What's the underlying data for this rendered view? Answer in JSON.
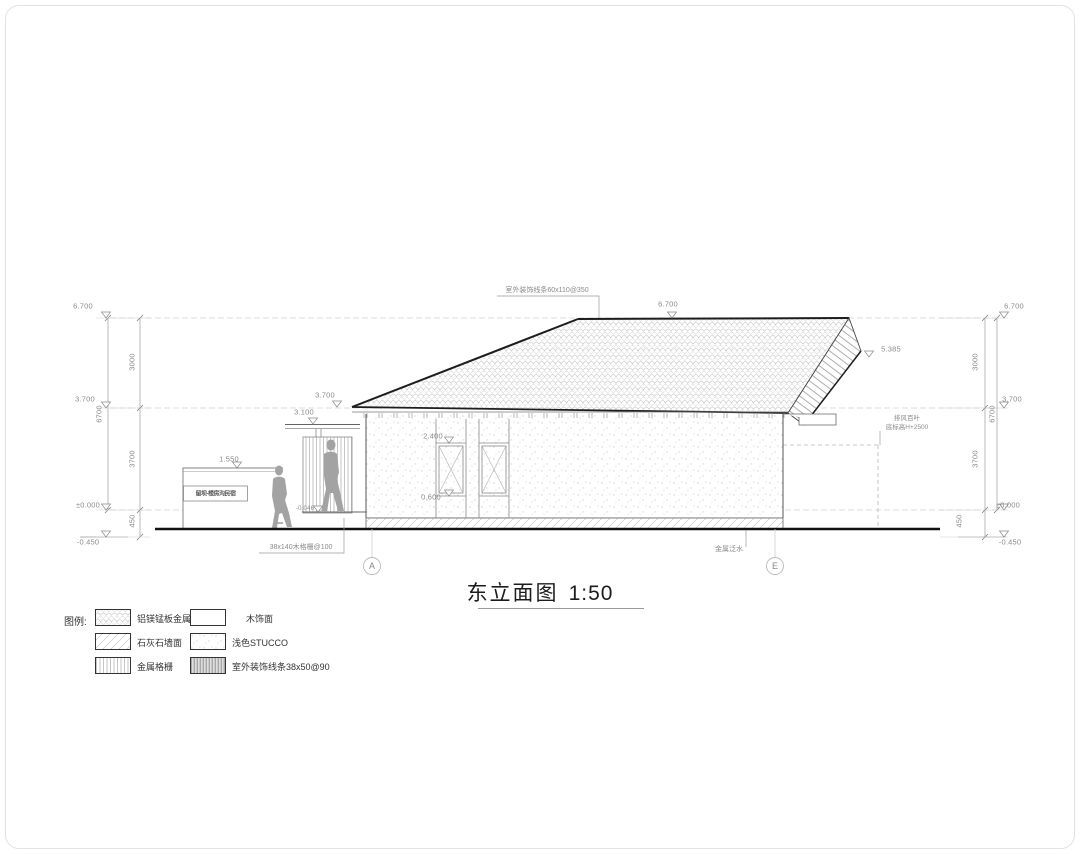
{
  "title": {
    "text": "东立面图",
    "scale": "1:50"
  },
  "levels": {
    "top": "6.700",
    "mid": "3.700",
    "zero": "±0.000",
    "ground": "-0.450",
    "seg_top": "3000",
    "seg_mid": "3700",
    "seg_bottom": "450",
    "overall": "6700"
  },
  "markers": {
    "ridge": "6.700",
    "right_eave": "5.385",
    "left_eave": "3.700",
    "canopy": "3.100",
    "sign_wall": "1.550",
    "window_head": "2.400",
    "window_sill": "0.600",
    "entry_step": "-0.046"
  },
  "annotations": {
    "roof_trim": "室外装饰线条60x110@350",
    "louver_line1": "排风百叶",
    "louver_line2": "底标高H+2500",
    "wood_grille": "38x140木格栅@100",
    "metal_flashing": "金属泛水",
    "sign_text": "留坝·楼房沟民宿"
  },
  "grid": {
    "a": "A",
    "e": "E"
  },
  "legend": {
    "title": "图例:",
    "items": [
      {
        "key": "metal-tile",
        "label": "铝镁锰板金属瓦"
      },
      {
        "key": "wood-finish",
        "label": "木饰面"
      },
      {
        "key": "limestone",
        "label": "石灰石墙面"
      },
      {
        "key": "stucco",
        "label": "浅色STUCCO"
      },
      {
        "key": "metal-grille",
        "label": "金属格栅"
      },
      {
        "key": "exterior-trim",
        "label": "室外装饰线条38x50@90"
      }
    ]
  }
}
